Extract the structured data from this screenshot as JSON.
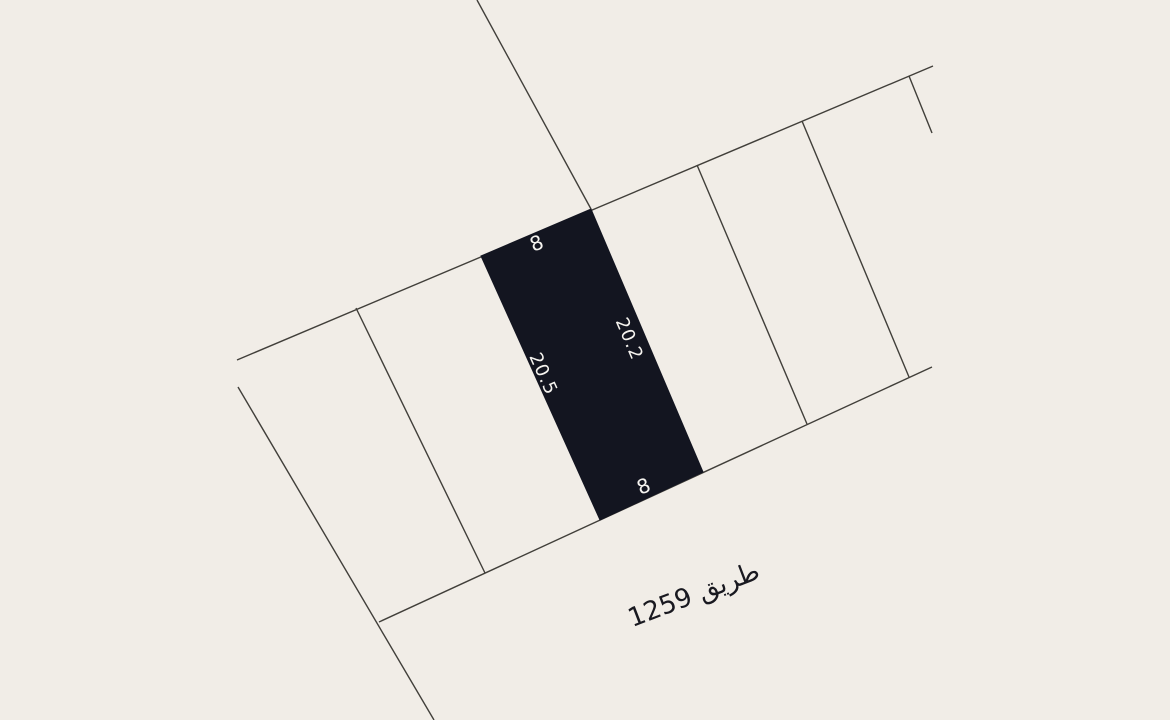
{
  "colors": {
    "background": "#f1ede7",
    "parcel_line": "#413f3a",
    "selected_parcel_fill": "#131520",
    "dimension_text": "#f5f3ef",
    "road_text": "#191920"
  },
  "map": {
    "road": {
      "label": "طريق 1259"
    },
    "selected_parcel": {
      "dimension_top": "8",
      "dimension_bottom": "8",
      "dimension_left": "20.5",
      "dimension_right": "20.2"
    }
  }
}
